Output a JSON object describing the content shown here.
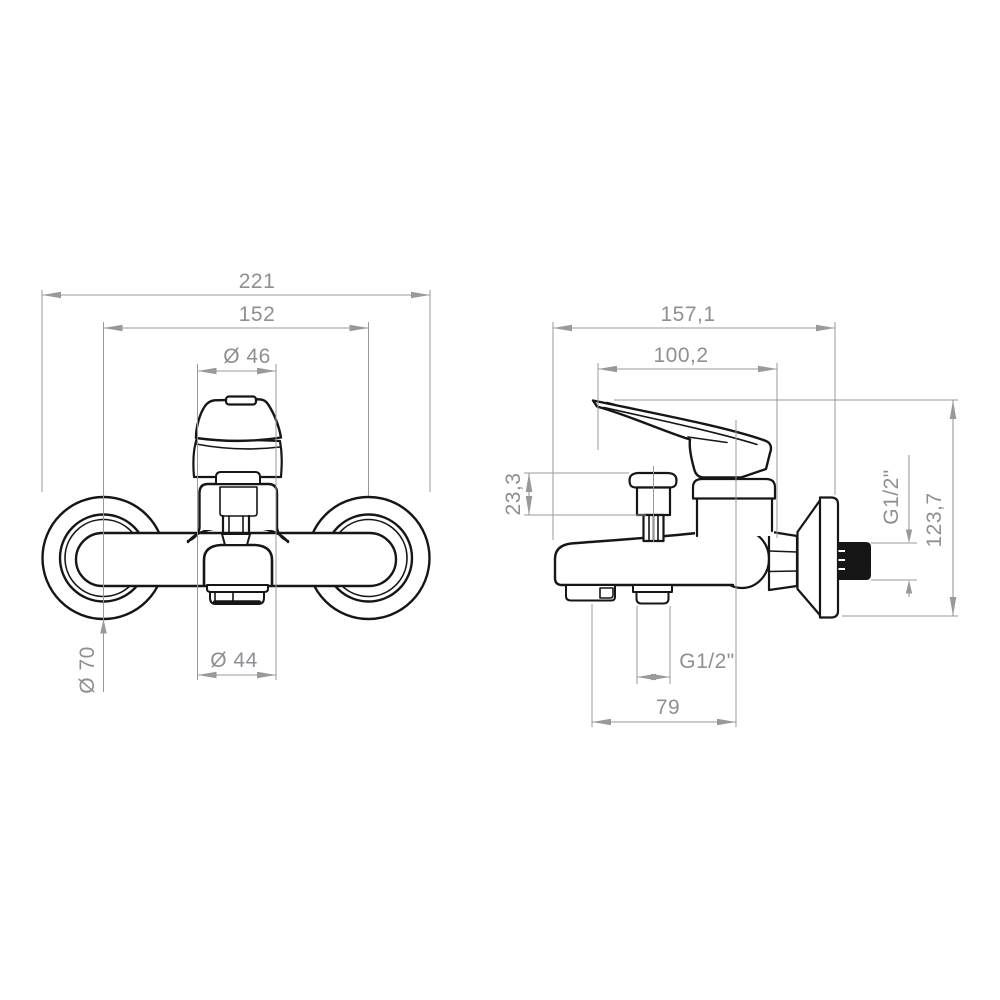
{
  "drawing": {
    "title": "wall-mounted-bath-mixer-dimensional-drawing",
    "front_view": {
      "overall_width": "221",
      "hole_spacing": "152",
      "handle_top_diameter": "Ø 46",
      "escutcheon_diameter": "Ø 70",
      "aerator_diameter": "Ø 44"
    },
    "side_view": {
      "total_depth": "157,1",
      "handle_projection": "100,2",
      "diverter_knob_height": "23,3",
      "wall_connection_thread": "G1/2\"",
      "total_height": "123,7",
      "outlet_thread": "G1/2\"",
      "spout_reach": "79"
    },
    "colors": {
      "line": "#161616",
      "dimension": "#97999c",
      "dimension_text": "#8d8f92",
      "background": "#ffffff"
    }
  }
}
